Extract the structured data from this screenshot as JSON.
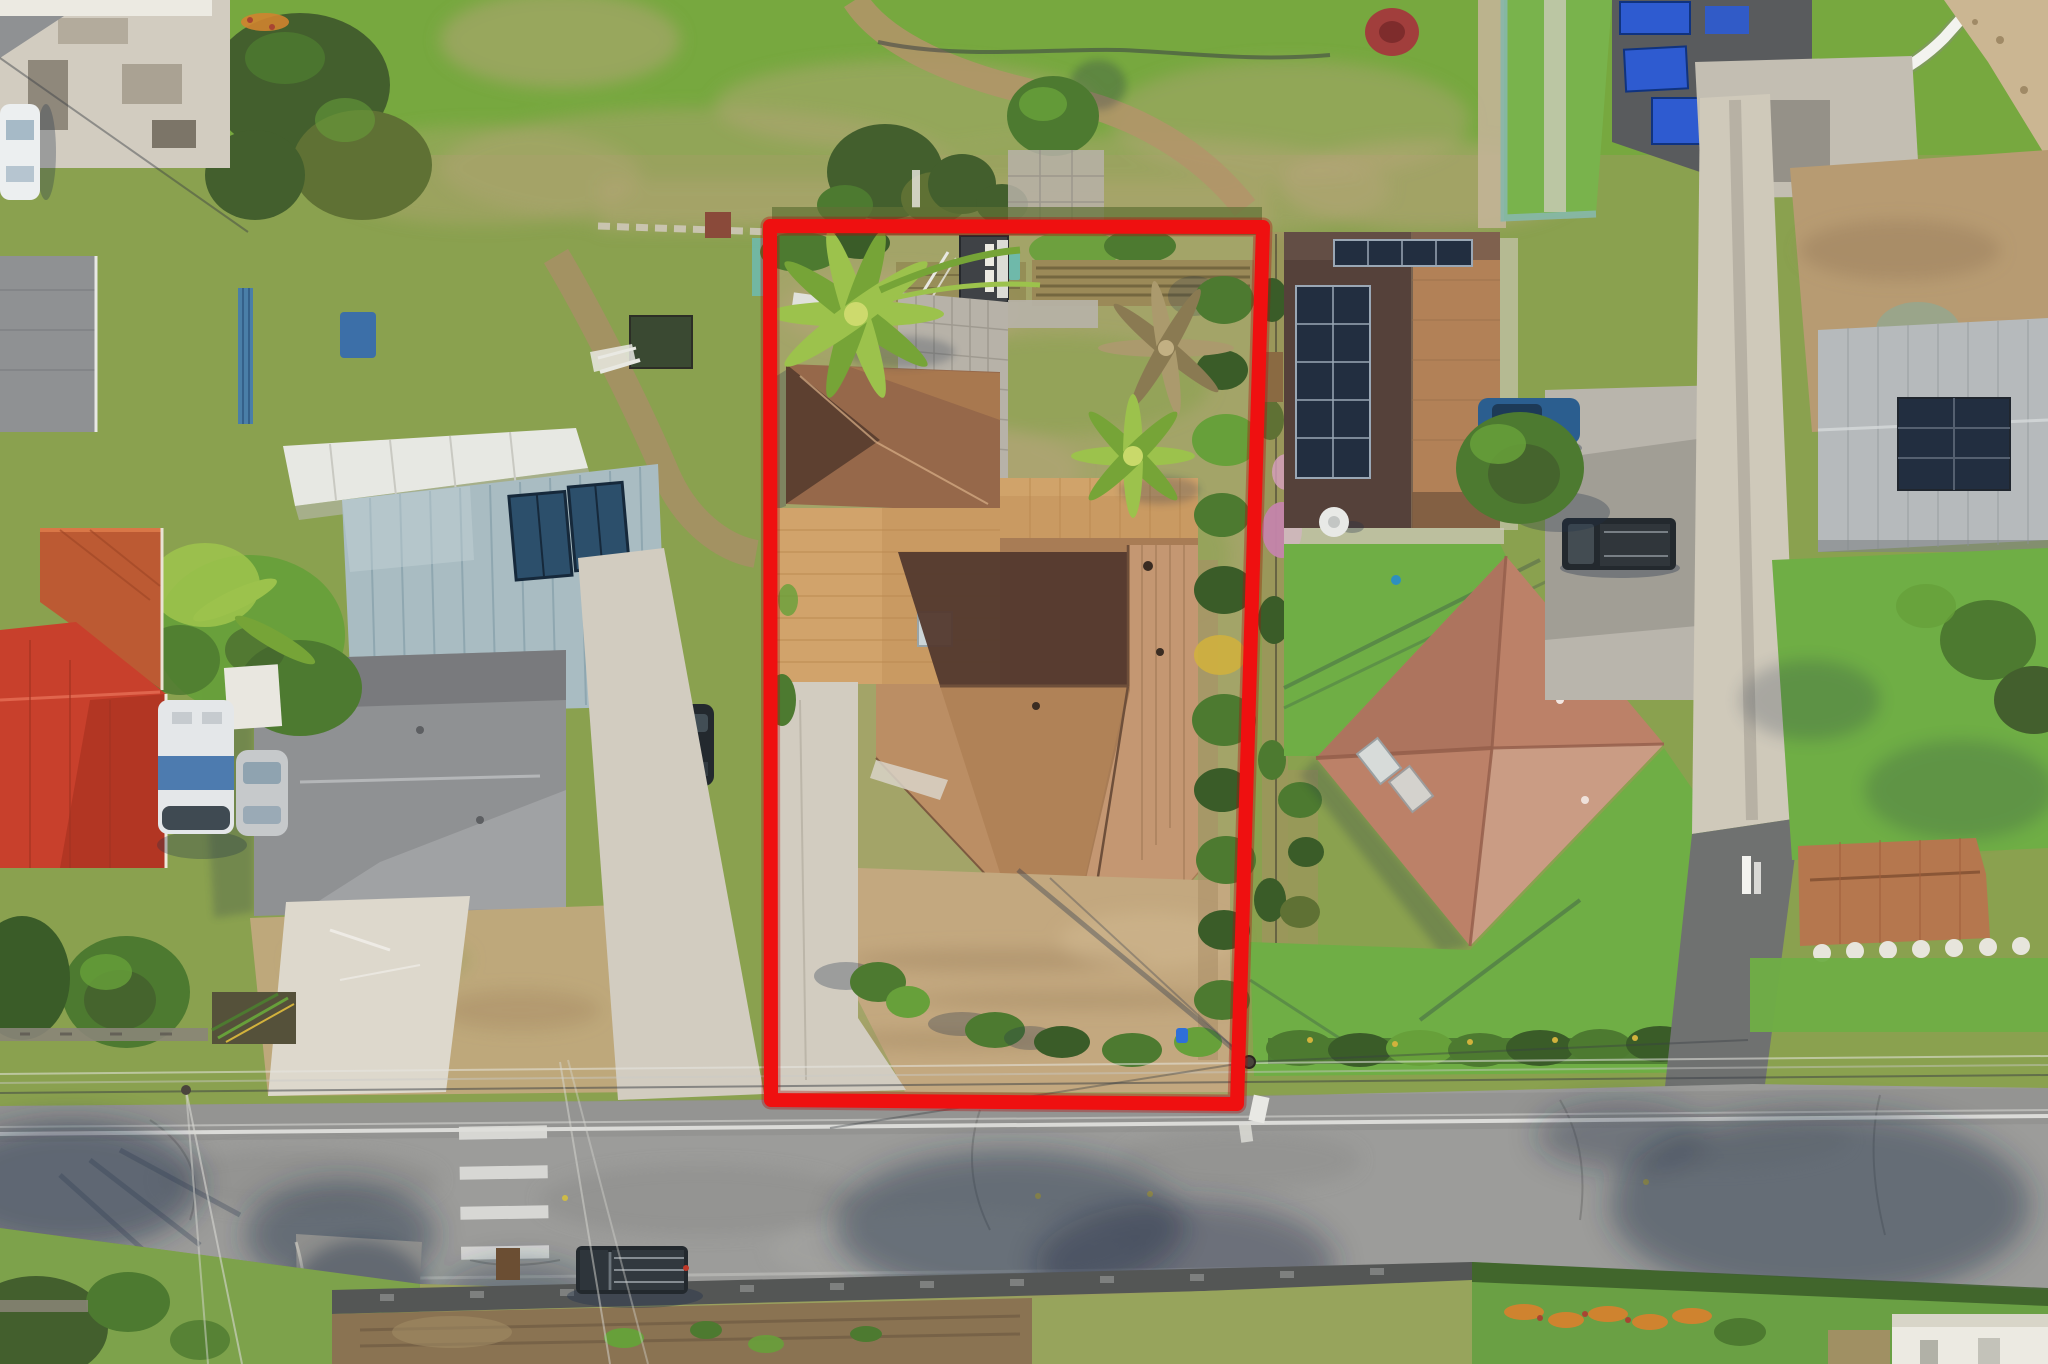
{
  "meta": {
    "type": "aerial-drone-photograph",
    "description": "Overhead aerial photo of a residential neighborhood; a red quadrilateral outline highlights a subject property containing a brown-shingle hip-roof house, tan flat carport roof, detached garage, dark shed, palm trees, paver patio, concrete driveway and a dirt front yard, bordered by hedges. Neighboring lots include houses with solar panels, metal roofs, red tile roofs, lawns, driveways with cars, an open grassy field at top, and an asphalt road with a crosswalk at bottom.",
    "width_px": 2048,
    "height_px": 1364,
    "visible_text": ""
  },
  "annotation": {
    "name": "property-boundary-outline",
    "shape": "quadrilateral",
    "color": "#ef1010",
    "stroke_width_px": 14,
    "corners_px": {
      "top_left": [
        770,
        226
      ],
      "top_right": [
        1263,
        227
      ],
      "bottom_right": [
        1237,
        1104
      ],
      "bottom_left": [
        771,
        1100
      ]
    }
  },
  "scene": {
    "subject_property": [
      "main hip-roof house (brown shingles, shadowed north slopes)",
      "tan flat carport/lanai roof",
      "detached garage hip roof",
      "dark shed with white doors",
      "paver patio",
      "two green palm trees",
      "one dry palm",
      "tilled garden rows",
      "perimeter hedge on east side",
      "concrete driveway to road",
      "bare dirt front yard",
      "shrub row at street side"
    ],
    "left_neighbors": [
      "white metal workshop roof",
      "steel-blue standing-seam metal roof with solar thermal panels",
      "large gray shingle hip roof house",
      "orange corrugated roof",
      "bright red tile hip roof",
      "banana tree cluster",
      "RV trailer",
      "silver car",
      "dark SUV",
      "white car on concrete pad",
      "blue fence",
      "blue dumpster",
      "garden beds",
      "big shade trees"
    ],
    "right_neighbors": [
      "dark roof house with two solar panel arrays and satellite dish",
      "green lawns",
      "salmon hip roof house with skylights",
      "gray parking slab with blue sedan and black pickup",
      "hedge rows along street",
      "utility pole with signs"
    ],
    "top_area": [
      "open scrubby field",
      "dirt path with garden hose",
      "red bush",
      "teal-edged lawn",
      "dark roof with bright blue solar panels",
      "curved white vinyl fence",
      "sandy corner lot",
      "long concrete driveway"
    ],
    "far_right": [
      "brown dirt field",
      "gray metal roof with dark solar array",
      "lawn with stepping stones",
      "terracotta tile roof",
      "hedge along road"
    ],
    "bottom_area": [
      "asphalt road with white edge line and crosswalk",
      "tree and palm shadows on pavement",
      "overhead utility wires",
      "rock retaining wall",
      "dirt garden strip",
      "black pickup truck with rack",
      "side lane",
      "grass verges with orange flowers",
      "white building corner"
    ]
  },
  "palette": {
    "grass_bright": "#76a93e",
    "grass_field": "#8aa14f",
    "grass_scrub": "#a3a468",
    "grass_dry": "#b9a67c",
    "grass_lawn": "#6fae45",
    "grass_shoulder": "#9aa05e",
    "dirt_path": "#b3946a",
    "dirt_yard": "#c3a87f",
    "dirt_brown": "#a98e66",
    "dirt_field": "#b79b72",
    "concrete": "#d2ccc0",
    "concrete_bright": "#ddd8cc",
    "paver": "#b7b2a8",
    "road": "#9c9c9a",
    "road_dark": "#8b8c8a",
    "asphalt_dark": "#6f7170",
    "rock_wall": "#545655",
    "red_outline": "#ef1010",
    "roof_sun": "#c49772",
    "roof_mid": "#a87c55",
    "roof_shadow": "#53392e",
    "tan_roof": "#c99a62",
    "tan_roof_light": "#d7ab72",
    "garage_roof": "#96684a",
    "shed_dark": "#3f4246",
    "white_paint": "#eceae2",
    "teal_metal_roof": "#a9bcc2",
    "white_metal_roof": "#e7e8e3",
    "gray_shingle": "#8f9193",
    "solar_thermal": "#2c4f6b",
    "orange_roof": "#bc5a33",
    "red_roof": "#c8402c",
    "dark_roof": "#55413a",
    "tan_shingle": "#b28157",
    "solar_panel": "#222e40",
    "salmon_roof": "#bc8168",
    "salmon_light": "#cfa68d",
    "salmon_ridge": "#96604c",
    "skylight": "#d7dbd9",
    "gray_metal": "#b6babc",
    "terracotta": "#b5774e",
    "solar_blue": "#2e5bd0",
    "teal_structure": "#6fb9aa",
    "teal_edge": "#87b7ab",
    "white_fence": "#f3f3ef",
    "hedge_dark": "#3a5c28",
    "hedge_mid": "#4d7a30",
    "hedge_bright": "#67a03a",
    "tree_dark": "#435f2d",
    "tree_olive": "#5f7134",
    "palm_bright": "#9cc24c",
    "palm_dark": "#76a437",
    "palm_dry": "#ab9a6d",
    "croton_orange": "#cf832f",
    "croton_yellow": "#d2b23c",
    "croton_red": "#a84432",
    "pink_flower": "#c585ac",
    "red_bush": "#a13e3c",
    "car_white": "#eceff0",
    "car_silver": "#c6c9cb",
    "car_blue": "#2b5e8f",
    "car_dark": "#23292e",
    "rv_blue": "#3c6fa8",
    "shadow": "#22314a",
    "wire_dark": "#3a3f45",
    "wire_light": "#dededa",
    "white_line": "#e8e8e4"
  }
}
